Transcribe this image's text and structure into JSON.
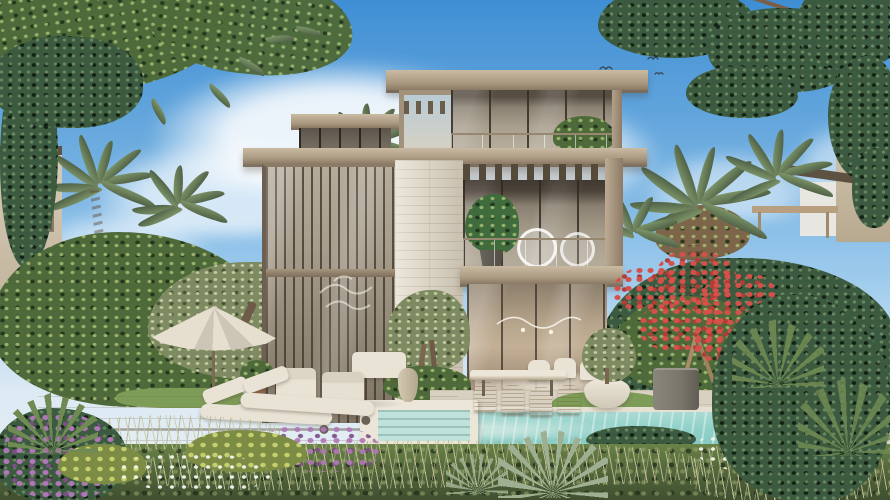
{
  "scene": {
    "description": "Daytime architectural rendering of a modern three-storey luxury villa with a louvred glass facade, travertine stone pier, landscaped tropical garden, swimming pool, sun deck with loungers and umbrella, under a blue sky with clouds and a flock of birds",
    "type": "architectural-render"
  },
  "objects": {
    "sky": {
      "label": "Blue sky with soft clouds and a flock of birds"
    },
    "villa": {
      "label": "Modern three-storey villa with bronze louvres, glass walls and travertine stone"
    },
    "pool": {
      "label": "Turquoise swimming pool with white stone spa ledge"
    },
    "garden": {
      "label": "Landscaped garden with palms, olive trees, flame tree and flower beds"
    },
    "deck": {
      "label": "Timber sun deck with two loungers and a patio umbrella"
    },
    "dining": {
      "label": "Outdoor dining table with wicker chairs"
    },
    "lounge": {
      "label": "Outdoor lounge armchairs and sofa"
    },
    "umbrella": {
      "label": "Beige patio umbrella"
    },
    "loungers": {
      "label": "Pair of cushioned sun loungers"
    },
    "birds": {
      "label": "Flock of birds in the sky"
    },
    "flame_tree": {
      "label": "Red flowering flame tree"
    },
    "neighbors": {
      "label": "Neighbouring villas behind the trees"
    }
  },
  "colors": {
    "sky_top": "#3f8ed4",
    "sky_horizon": "#dceaf4",
    "cloud": "#f8fafa",
    "villa_fascia": "#b3a28b",
    "villa_stone": "#e2dbcc",
    "villa_glass": "#8f8576",
    "louver_bronze": "#55493a",
    "pool_water": "#84c8c2",
    "pool_steps": "#bfe2da",
    "coping": "#e6e0d2",
    "deck_wood": "#cdc1ae",
    "terrace_stone": "#d8d0c0",
    "lawn": "#7d9c57",
    "foliage": "#55693c",
    "olive": "#7e8a62",
    "palm": "#7d9468",
    "pine": "#3c5a40",
    "flower_red": "#d6504a",
    "flower_purple": "#a268a8",
    "flower_white": "#eef0e8",
    "umbrella": "#e0d9ca",
    "cushion": "#e9e3d5",
    "wicker": "#c4a274",
    "trunk": "#8a7258",
    "planter_white": "#eee9dc",
    "pillar_gray": "#7a766b",
    "interior_warm": "#c3b096",
    "neighbor_wall": "#cfc3ae"
  }
}
